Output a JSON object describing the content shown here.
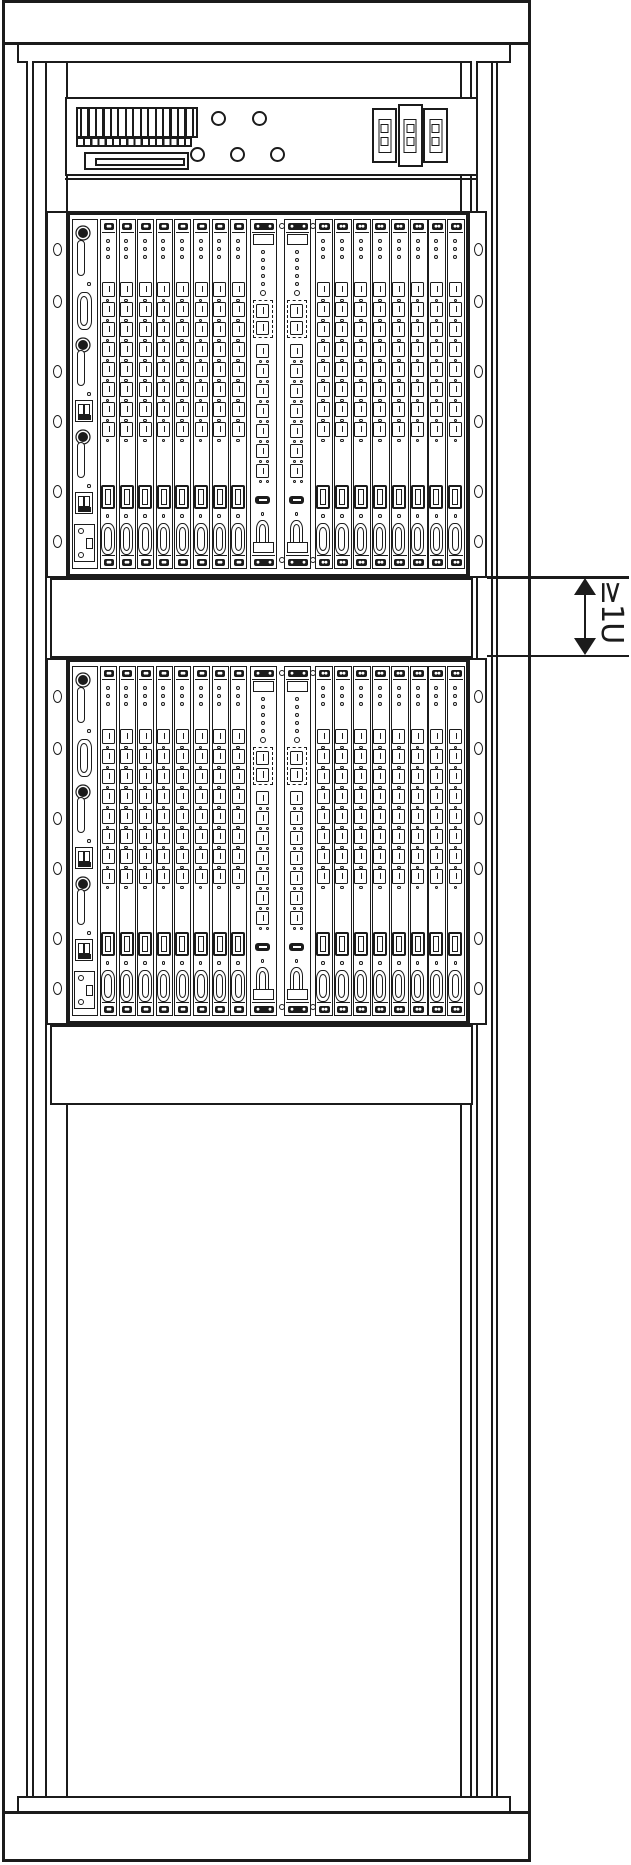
{
  "figure": {
    "type": "rack-installation-diagram",
    "line_color": "#1b1b1b",
    "background_color": "#ffffff",
    "dimension_annotation": {
      "label": "≥1U"
    }
  },
  "rack": {
    "power_panel": {
      "terminal_block": {
        "stripe_count": 16
      },
      "indicator_lights": {
        "top_row": 2,
        "bottom_row": 3
      },
      "circuit_breakers": {
        "count": 3,
        "windows_per_breaker": 2
      }
    },
    "subracks": [
      {
        "id": "subrack-1"
      },
      {
        "id": "subrack-2"
      }
    ],
    "spacer_panels": 2,
    "subrack_template": {
      "mounting_flange_holes_per_side": 6,
      "card_sections": {
        "left_narrow_cards": 8,
        "center_wide_cards": 2,
        "right_narrow_cards": 8
      },
      "narrow_card": {
        "led_count": 3,
        "rj45_port_count": 8,
        "wide_port_count": 1,
        "dsub_connector_count": 1
      },
      "wide_card": {
        "led_count": 5,
        "dual_port_blocks": 1,
        "rj45_port_count": 7,
        "usb_port_count": 1,
        "dsub_connector_count": 1
      },
      "left_panel": {
        "handle_slots": 3,
        "dsub_connector_count": 1,
        "fuse_blocks": 2,
        "knobs": 3
      }
    }
  }
}
